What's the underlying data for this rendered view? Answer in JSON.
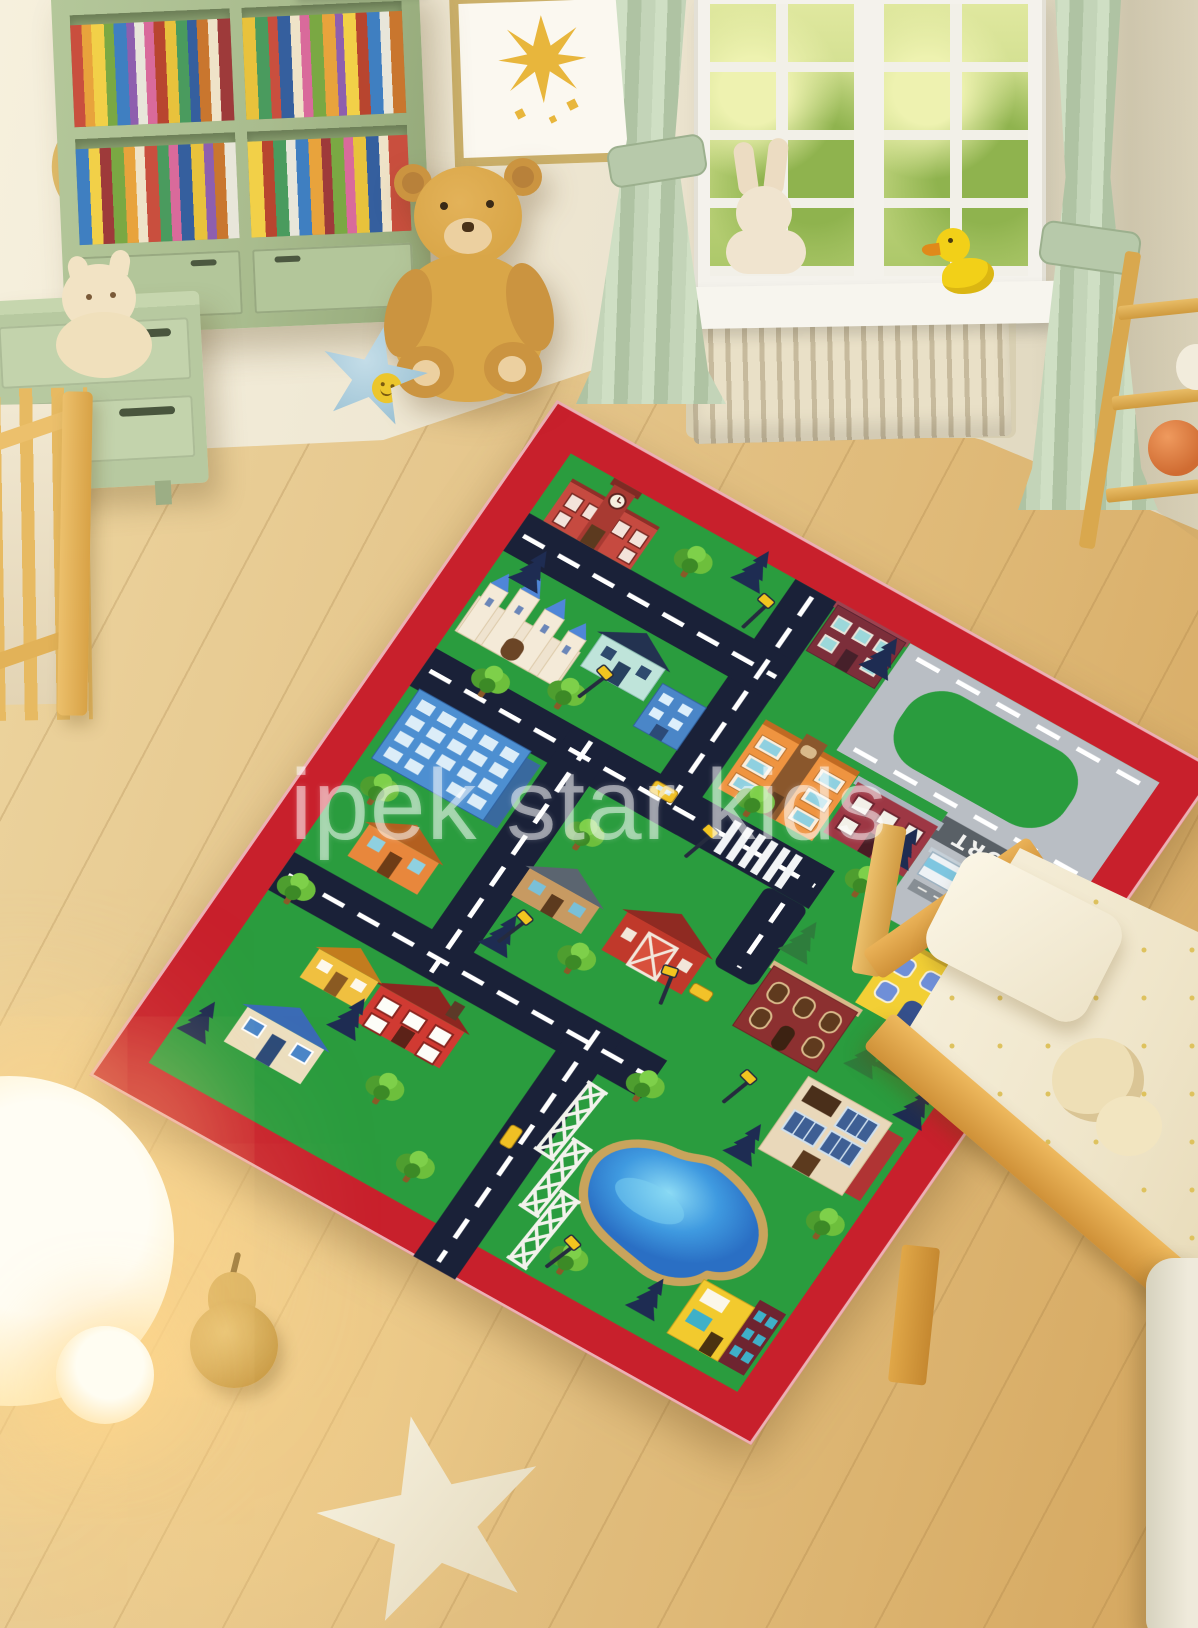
{
  "image": {
    "kind": "product-photo",
    "subject": "Children's city road play rug shown in a pastel kids bedroom"
  },
  "watermark": {
    "text": "ipek star kids"
  },
  "rug": {
    "airport_label": "AIRPORT"
  },
  "colors": {
    "rug_border": "#c8202c",
    "rug_field": "#2a9c3e",
    "road": "#1a2138",
    "road_dash": "#ffffff",
    "runway": "#b9bec4",
    "runway_band": "#596066",
    "lake": "#2e86d8",
    "lake_rim": "#c9a45c",
    "wall": "#ece4cf",
    "floor": "#e5c68c",
    "curtain": "#c3d4b8",
    "bookshelf": "#a9bc8e",
    "wood": "#e2ae54",
    "teddy": "#d9a648",
    "duck": "#f2d018",
    "lamp_glow": "#ffd98e"
  },
  "objects": [
    "bookshelf with colorful books",
    "green nightstand",
    "cat plush",
    "wooden wall ring",
    "framed sun picture",
    "teddy bear",
    "blue star plush",
    "green curtains",
    "window with garden view",
    "bunny plush",
    "rubber duck",
    "radiator",
    "wooden ladder shelf",
    "orange ball",
    "wooden crib",
    "city road play rug",
    "airport runway",
    "lake",
    "power pylons",
    "toy town buildings",
    "toddler bed",
    "pillow",
    "bed plush",
    "glowing sphere lamps",
    "felt pear",
    "star pillow"
  ]
}
